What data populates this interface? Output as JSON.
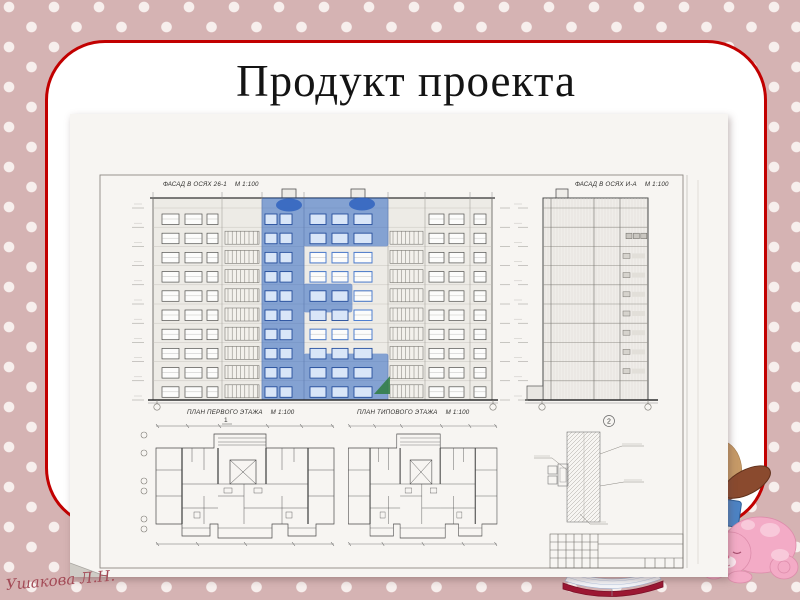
{
  "slide": {
    "title": "Продукт проекта",
    "signature": "Ушакова Л.Н.",
    "colors": {
      "background_pink": "#d5b3b3",
      "polka_dot": "#f7efed",
      "card_border_red": "#c20000",
      "sheet": "#f7f5f2",
      "marker_blue": "#3a6ec5",
      "marker_green": "#2e7d42"
    }
  },
  "drawing": {
    "facade_main": {
      "label": "ФАСАД В ОСЯХ 26-1",
      "scale": "М 1:100",
      "floors": 10
    },
    "facade_side": {
      "label": "ФАСАД В ОСЯХ И-А",
      "scale": "М 1:100"
    },
    "plan_first": {
      "label": "ПЛАН ПЕРВОГО ЭТАЖА",
      "scale": "М 1:100"
    },
    "plan_typical": {
      "label": "ПЛАН ТИПОВОГО ЭТАЖА",
      "scale": "М 1:100"
    },
    "section_mark": "1",
    "detail_callout": "2"
  }
}
